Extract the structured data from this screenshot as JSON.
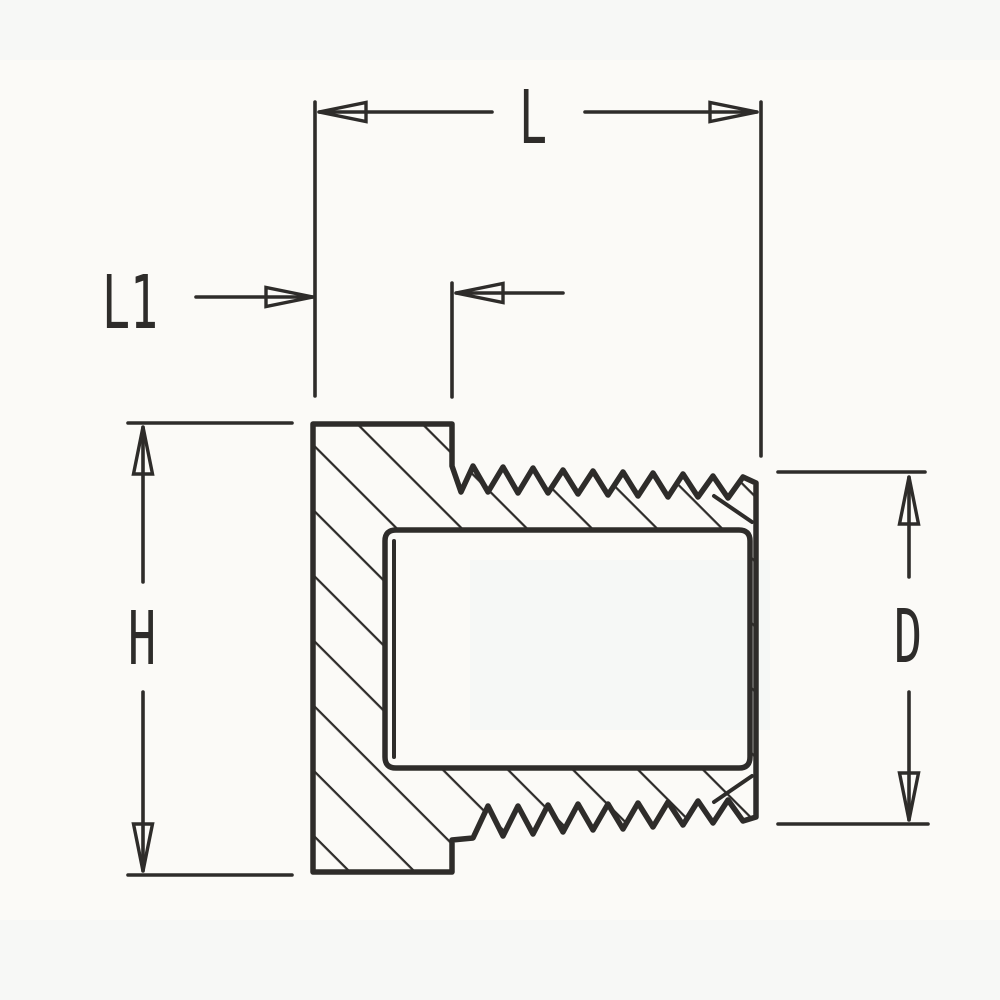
{
  "drawing": {
    "colors": {
      "ink": "#2e2c2a",
      "paper": "#fbfaf7",
      "scan_tint": "#eef3f4"
    },
    "dimension_labels": {
      "overall_length": "L",
      "head_length": "L1",
      "head_height": "H",
      "thread_diameter": "D"
    }
  }
}
